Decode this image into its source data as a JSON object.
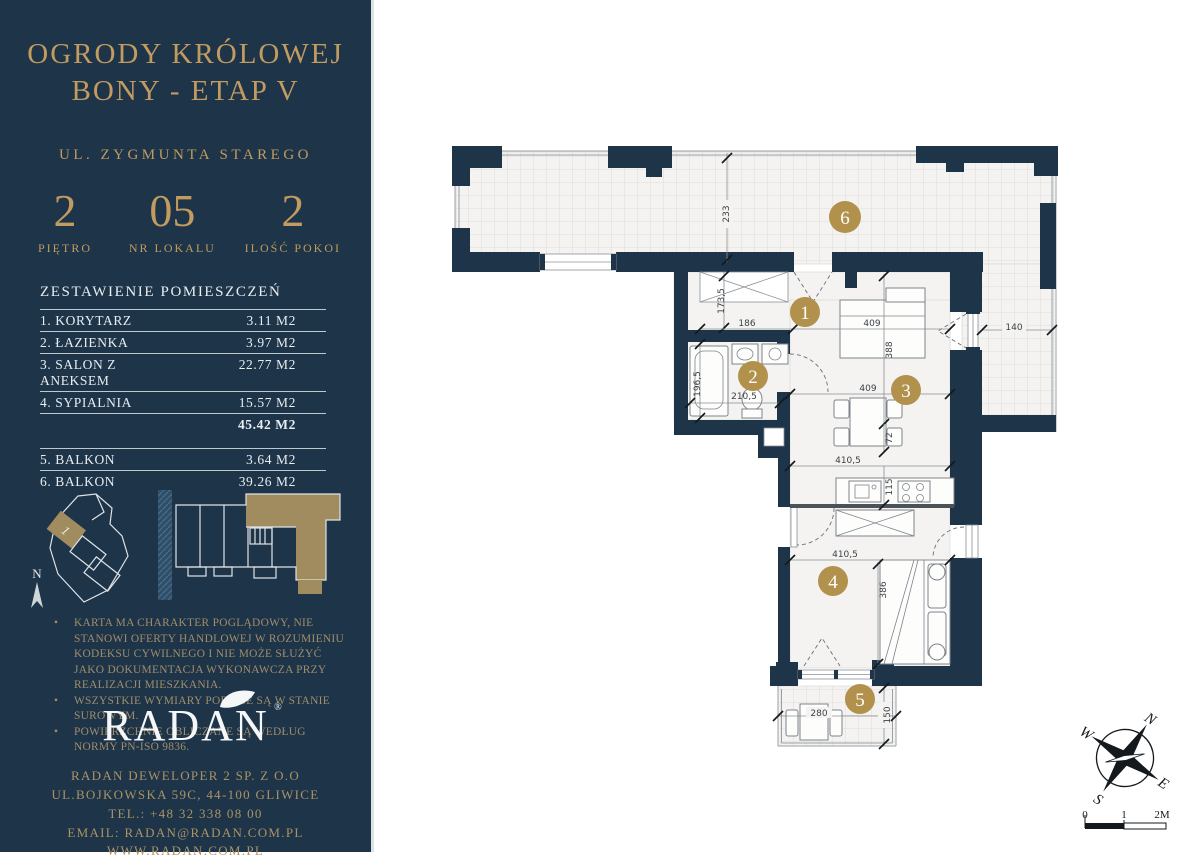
{
  "sidebar": {
    "title_line1": "OGRODY KRÓLOWEJ",
    "title_line2": "BONY - ETAP V",
    "subtitle": "UL. ZYGMUNTA STAREGO",
    "stats": [
      {
        "value": "2",
        "label": "PIĘTRO"
      },
      {
        "value": "05",
        "label": "NR LOKALU"
      },
      {
        "value": "2",
        "label": "ILOŚĆ POKOI"
      }
    ],
    "rooms_table": {
      "heading": "ZESTAWIENIE POMIESZCZEŃ",
      "rows": [
        {
          "name": "1. KORYTARZ",
          "area": "3.11 M2"
        },
        {
          "name": "2. ŁAZIENKA",
          "area": "3.97 M2"
        },
        {
          "name": "3. SALON Z ANEKSEM",
          "area": "22.77 M2"
        },
        {
          "name": "4. SYPIALNIA",
          "area": "15.57 M2"
        }
      ],
      "total": "45.42 M2",
      "balcony_rows": [
        {
          "name": "5. BALKON",
          "area": "3.64 M2"
        },
        {
          "name": "6. BALKON",
          "area": "39.26 M2"
        }
      ]
    },
    "north_label": "N",
    "site_unit_label": "1",
    "disclaimer": [
      "KARTA MA CHARAKTER POGLĄDOWY, NIE STANOWI OFERTY HANDLOWEJ W ROZUMIENIU KODEKSU CYWILNEGO I NIE MOŻE SŁUŻYĆ JAKO DOKUMENTACJA WYKONAWCZA PRZY REALIZACJI MIESZKANIA.",
      "WSZYSTKIE WYMIARY PODANE SĄ W STANIE SUROWYM.",
      "POWIERZCHNIE OBLICZANE SĄ WEDŁUG NORMY PN-ISO 9836."
    ],
    "logo_text": "RADAN",
    "logo_reg": "®",
    "contact": [
      "RADAN DEWELOPER 2 SP. Z O.O",
      "UL.BOJKOWSKA 59C, 44-100 GLIWICE",
      "TEL.: +48 32 338 08 00",
      "EMAIL: RADAN@RADAN.COM.PL",
      "WWW.RADAN.COM.PL"
    ]
  },
  "plan": {
    "rooms": {
      "r1": "1",
      "r2": "2",
      "r3": "3",
      "r4": "4",
      "r5": "5",
      "r6": "6"
    },
    "dims": {
      "d233": "233",
      "d173_5": "173,5",
      "d186": "186",
      "d409a": "409",
      "d388": "388",
      "d72": "72",
      "d409b": "409",
      "d410_5a": "410,5",
      "d115": "115",
      "d410_5b": "410,5",
      "d386": "386",
      "d280": "280",
      "d150": "150",
      "d140": "140",
      "d196_5": "196,5",
      "d210_5": "210,5"
    },
    "compass": {
      "n": "N",
      "w": "W",
      "e": "E",
      "s": "S"
    },
    "scale": {
      "t0": "0",
      "t1": "1",
      "t2": "2M"
    }
  },
  "colors": {
    "navy": "#1d3449",
    "gold": "#c19b60",
    "muted_gold": "#a18e6c",
    "contact_gold": "#ab9366",
    "room_marker": "#b2914d",
    "floor": "#f4f3f1",
    "unit_highlight": "#a18c5f"
  }
}
